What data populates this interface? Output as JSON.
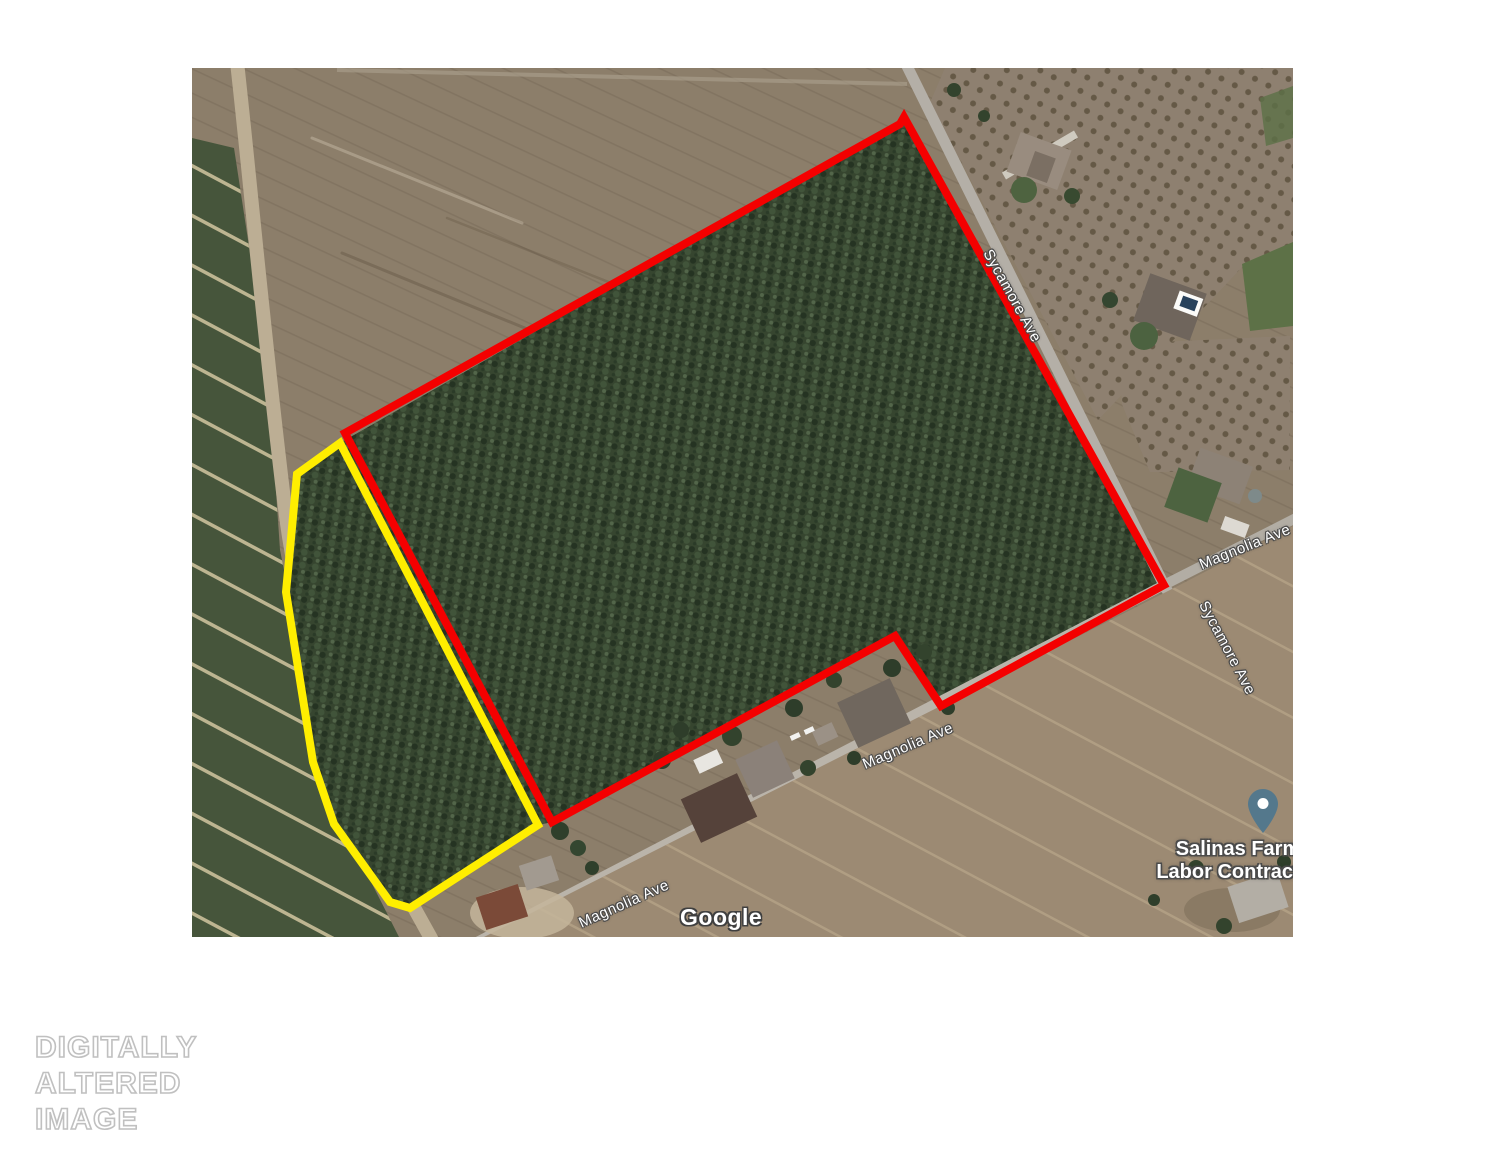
{
  "map": {
    "provider_watermark": "Google",
    "street_labels": [
      {
        "id": "sycamore-upper",
        "text": "Sycamore Ave"
      },
      {
        "id": "magnolia-right",
        "text": "Magnolia Ave"
      },
      {
        "id": "sycamore-lower",
        "text": "Sycamore Ave"
      },
      {
        "id": "magnolia-mid",
        "text": "Magnolia Ave"
      },
      {
        "id": "magnolia-lower-left",
        "text": "Magnolia Ave"
      }
    ],
    "place": {
      "name_line1": "Salinas Farm",
      "name_line2": "Labor Contractor",
      "pin_color": "#54788c"
    },
    "overlays": [
      {
        "name": "primary-parcel-outline",
        "color": "#f40000"
      },
      {
        "name": "secondary-parcel-outline",
        "color": "#ffee00"
      }
    ]
  },
  "disclaimer": {
    "line1": "DIGITALLY",
    "line2": "ALTERED",
    "line3": "IMAGE"
  }
}
